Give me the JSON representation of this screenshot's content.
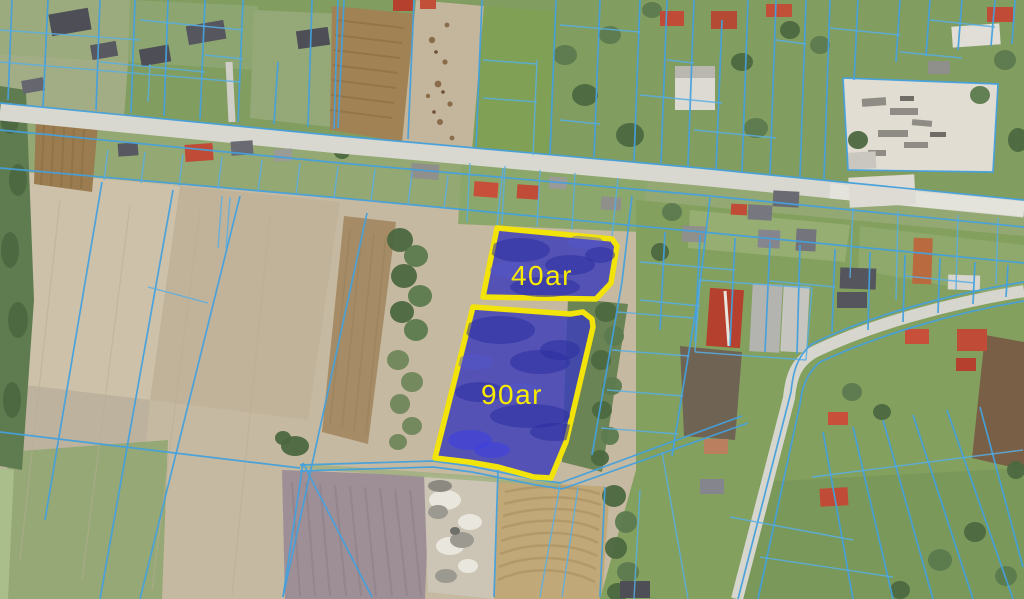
{
  "map": {
    "title": "Aerial cadastral map with two highlighted parcels for sale",
    "highlighted_parcels": [
      {
        "label": "40ar",
        "points": "497,228 612,239 617,246 611,283 596,299 483,297"
      },
      {
        "label": "90ar",
        "points": "473,307 570,314 583,312 592,319 593,327 566,442 551,478 534,477 498,467 469,462 435,458"
      }
    ],
    "colors": {
      "parcel_fill": "#3b3db9",
      "parcel_border": "#f2e30a",
      "parcel_label": "#f8eb00",
      "cadastral_line": "#45a0dc",
      "road": "#d8d8d0",
      "farmland": "#c6b9a1",
      "grass": "#829d60"
    }
  }
}
